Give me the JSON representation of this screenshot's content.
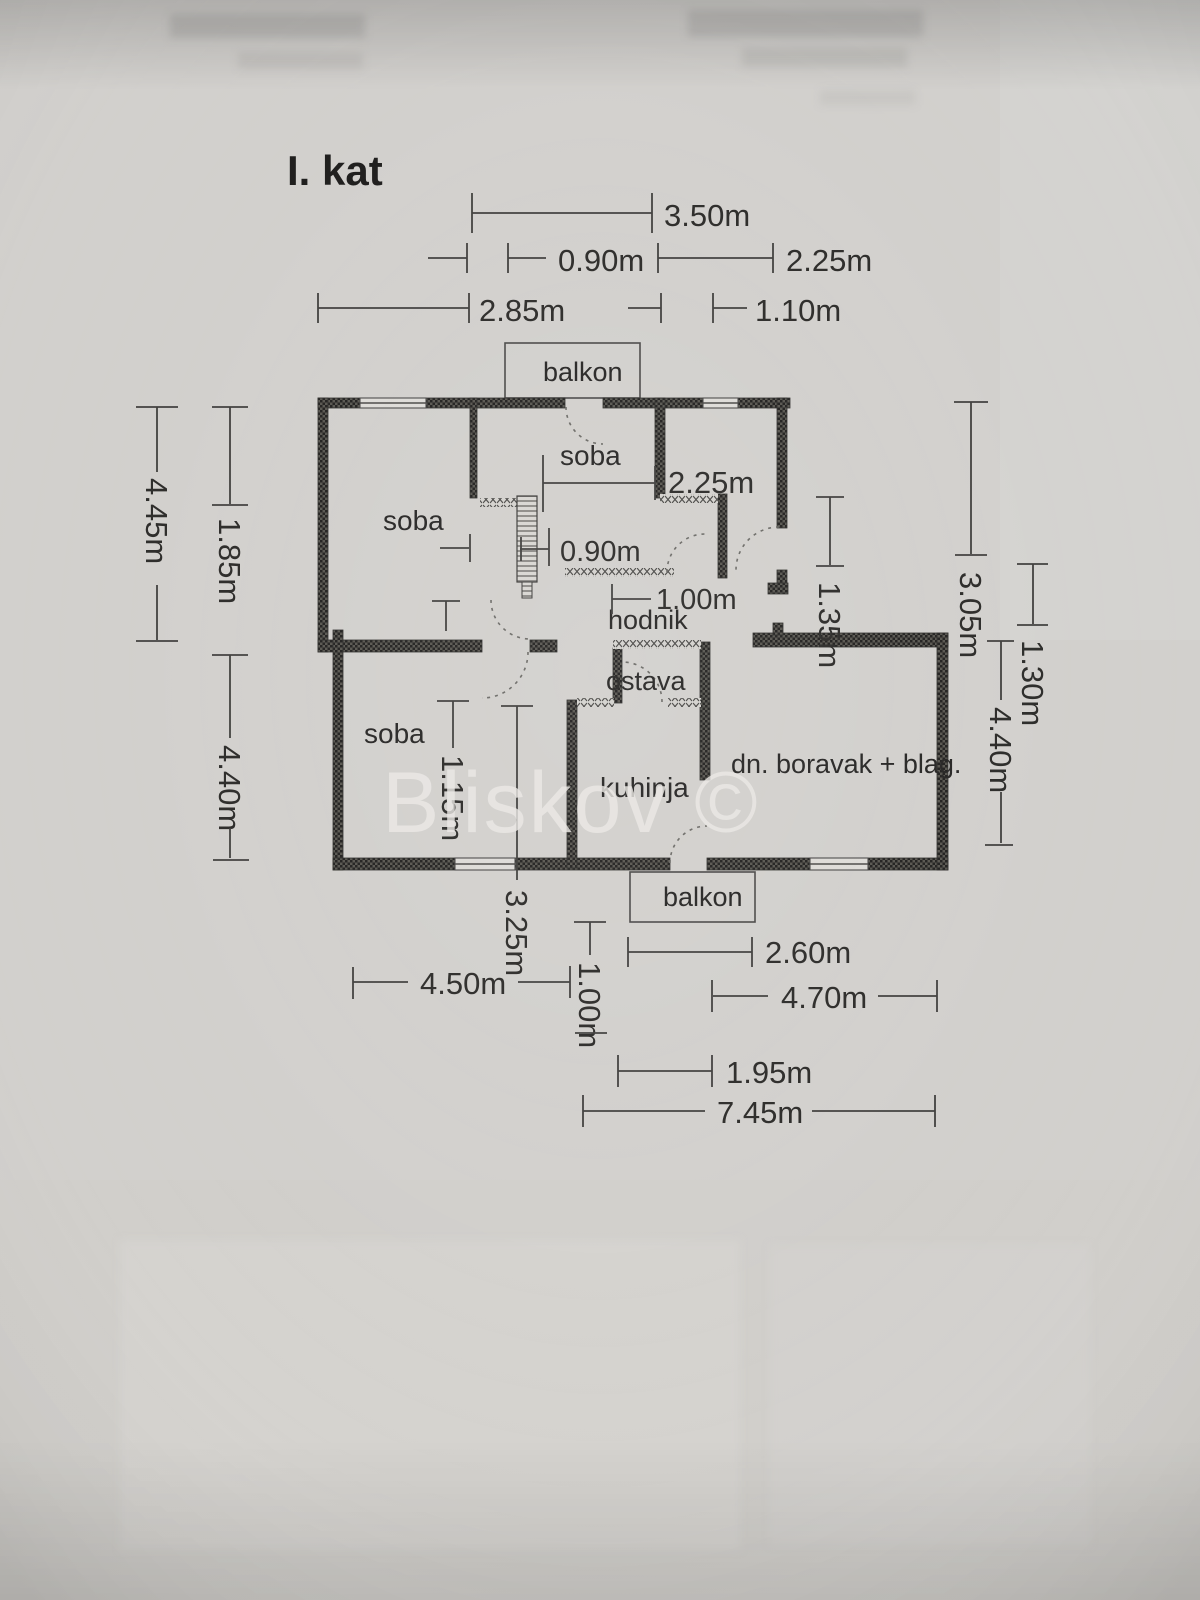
{
  "title": "I. kat",
  "watermark": "Bliskov ©",
  "rooms": {
    "balkon_top": "balkon",
    "soba_top_left": "soba",
    "soba_top_middle": "soba",
    "soba_bottom_left": "soba",
    "hodnik": "hodnik",
    "ostava": "ostava",
    "kuhinja": "kuhinja",
    "living": "dn. boravak + blag.",
    "balkon_bottom": "balkon"
  },
  "dims": {
    "top_350": "3.50m",
    "top_090": "0.90m",
    "top_225": "2.25m",
    "top_285": "2.85m",
    "top_110": "1.10m",
    "left_445": "4.45m",
    "left_185": "1.85m",
    "left_440": "4.40m",
    "right_305": "3.05m",
    "right_130": "1.30m",
    "right_440": "4.40m",
    "in_225": "2.25m",
    "in_090": "0.90m",
    "in_100": "1.00m",
    "in_135": "1.35m",
    "in_115": "1.15m",
    "in_325": "3.25m",
    "bottom_260": "2.60m",
    "bottom_450": "4.50m",
    "bottom_100": "1.00m",
    "bottom_470": "4.70m",
    "bottom_195": "1.95m",
    "bottom_745": "7.45m"
  }
}
